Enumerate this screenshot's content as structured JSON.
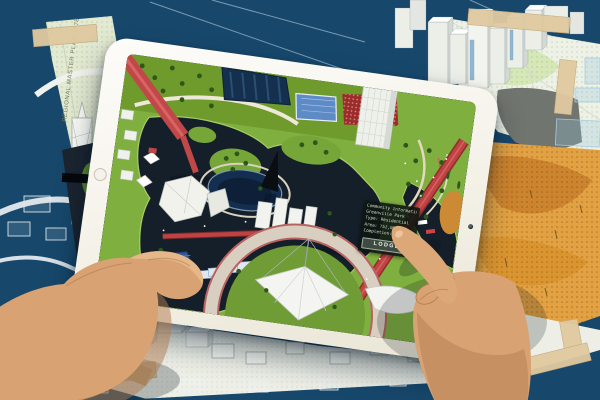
{
  "scene": {
    "background_color": "#17486c",
    "tape_color": "#dfc9a0",
    "screen_park_green": "#7fb03f",
    "screen_water": "#151f2a",
    "bridge_red": "#c04343"
  },
  "blueprint": {
    "side_label": "REGIONAL MASTER PLAN 1978"
  },
  "tablet": {
    "popup": {
      "lines": [
        "Community Information",
        "Greenville Park",
        "Type: Residential",
        "Area: 752,000sqm",
        "Completion: 2008"
      ],
      "button_label": "LODGE"
    }
  }
}
